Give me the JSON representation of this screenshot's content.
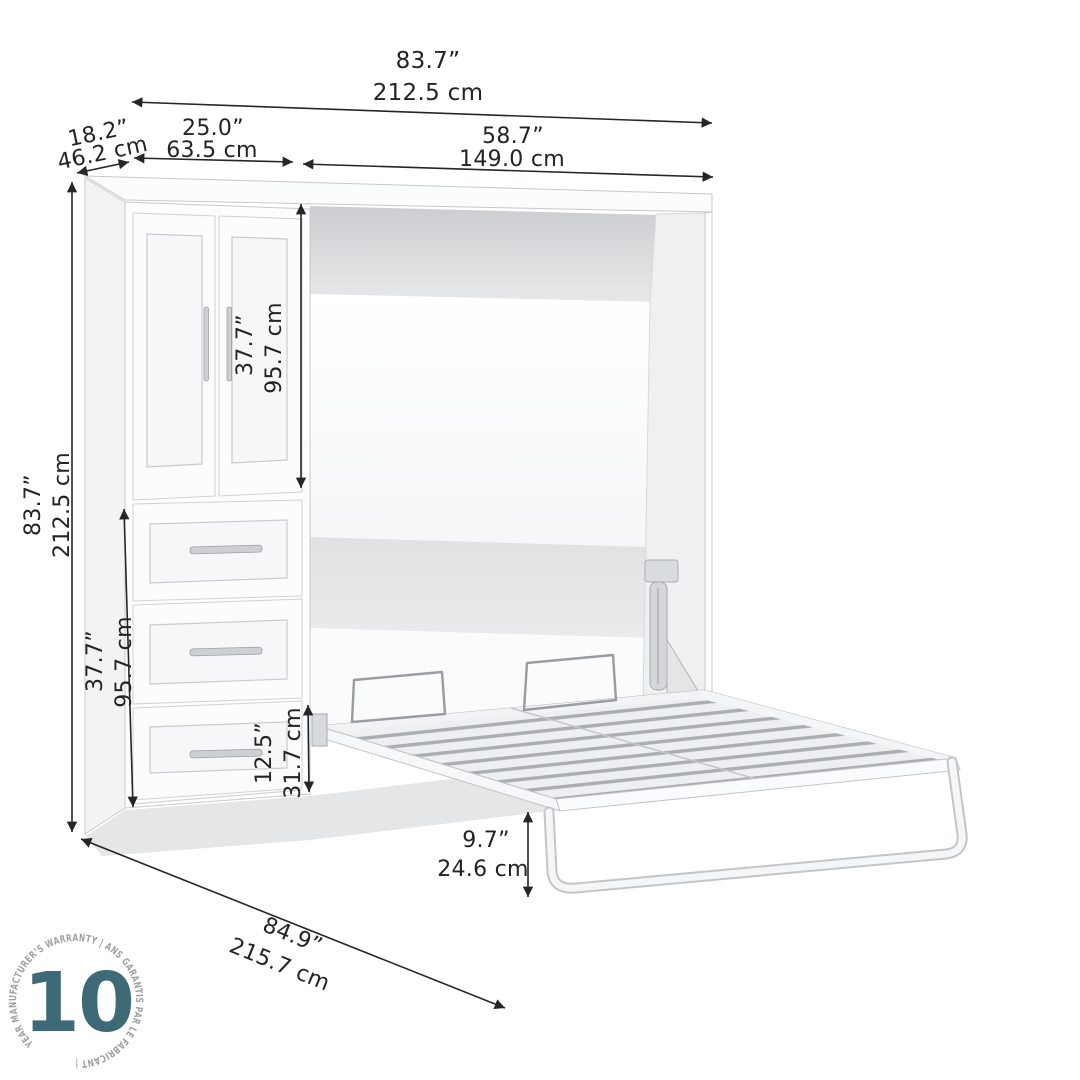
{
  "dimensions": {
    "overall_width": {
      "in": "83.7”",
      "cm": "212.5 cm"
    },
    "unit_depth": {
      "in": "18.2”",
      "cm": "46.2 cm"
    },
    "storage_width": {
      "in": "25.0”",
      "cm": "63.5 cm"
    },
    "bed_width": {
      "in": "58.7”",
      "cm": "149.0 cm"
    },
    "overall_height": {
      "in": "83.7”",
      "cm": "212.5 cm"
    },
    "door_height": {
      "in": "37.7”",
      "cm": "95.7 cm"
    },
    "drawer_stack_height": {
      "in": "37.7”",
      "cm": "95.7 cm"
    },
    "bottom_drawer_height": {
      "in": "12.5”",
      "cm": "31.7 cm"
    },
    "bed_frame_height": {
      "in": "9.7”",
      "cm": "24.6 cm"
    },
    "bed_open_depth": {
      "in": "84.9”",
      "cm": "215.7 cm"
    }
  },
  "warranty_badge": {
    "years": "10",
    "ring_text": "YEAR MANUFACTURER’S WARRANTY   |   ANS GARANTIS PAR LE FABRICANT   |",
    "number_color": "#3d6a76",
    "ring_text_color": "#a0a0a0"
  },
  "colors": {
    "dimension_ink": "#262626",
    "furniture_outline": "#c6c9cb",
    "interior_shadow": "#cdd0d2",
    "slat_gap": "#a9aeb2",
    "floor_shadow": "#e5e6e7"
  }
}
